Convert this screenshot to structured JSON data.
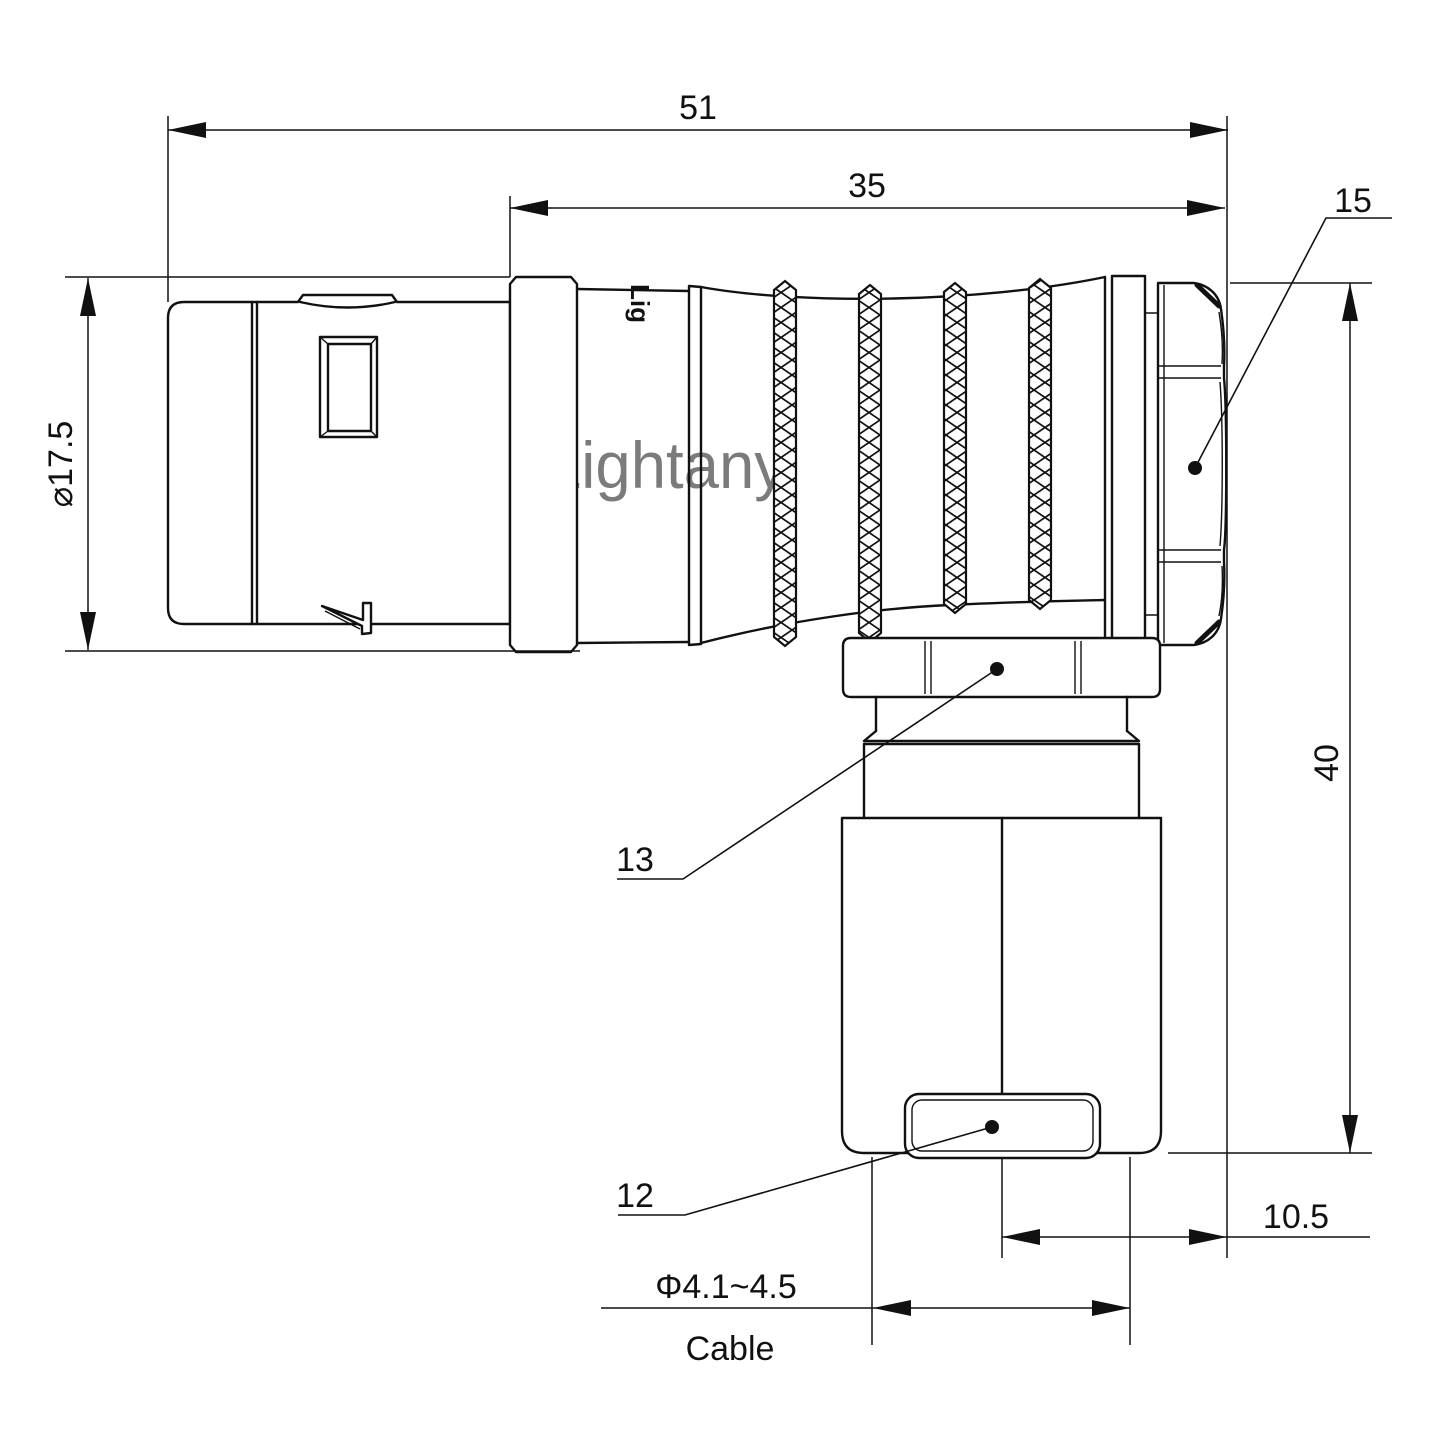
{
  "watermark": "Lightany",
  "engraving": "Lig",
  "colors": {
    "line": "#111111",
    "watermark": "#eea7a7"
  },
  "dims": {
    "overall_length": "51",
    "rear_length": "35",
    "part15_label": "15",
    "front_diameter": "⌀17.5",
    "height": "40",
    "part13_label": "13",
    "part12_label": "12",
    "offset": "10.5",
    "cable_diameter": "Φ4.1~4.5",
    "cable_word": "Cable"
  }
}
